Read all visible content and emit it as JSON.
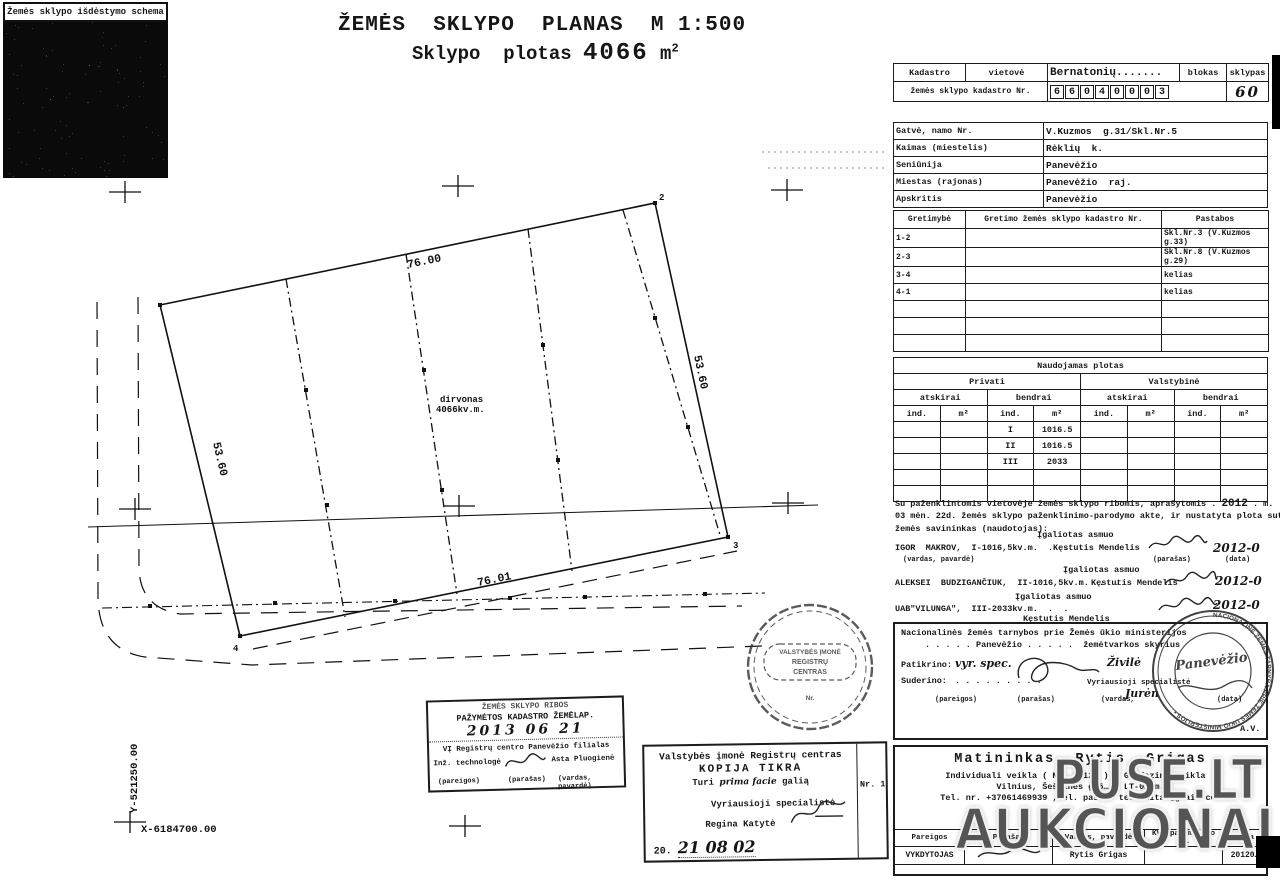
{
  "watermark": {
    "top": "PUSE.LT",
    "bottom": "AUKCIONAI"
  },
  "schema": {
    "caption": "Žemės sklypo išdėstymo schema"
  },
  "title": {
    "line1": "ŽEMĖS  SKLYPO  PLANAS  M 1:500",
    "line2_label": "Sklypo  plotas ",
    "area": "4066",
    "unit": " m",
    "sup": "2"
  },
  "kadastro": {
    "h_kadastro": "Kadastro",
    "h_vietove": "vietovė",
    "vietove_value": "Bernatonių.......",
    "h_blokas": "blokas",
    "h_sklypas": "sklypas",
    "row2_label": "žemės sklypo kadastro Nr.",
    "digits": [
      "6",
      "6",
      "0",
      "4",
      "0",
      "0",
      "0",
      "3"
    ],
    "sklypas_value": "60"
  },
  "address": {
    "rows": [
      {
        "label": "Gatvė, namo Nr.",
        "value": "V.Kuzmos  g.31/Skl.Nr.5"
      },
      {
        "label": "Kaimas (miestelis)",
        "value": "Rėklių  k."
      },
      {
        "label": "Seniūnija",
        "value": "Panevėžio"
      },
      {
        "label": "Miestas (rajonas)",
        "value": "Panevėžio  raj."
      },
      {
        "label": "Apskritis",
        "value": "Panevėžio"
      }
    ]
  },
  "gretimybe": {
    "h1": "Gretimybė",
    "h2": "Gretimo žemės sklypo kadastro Nr.",
    "h3": "Pastabos",
    "rows": [
      {
        "c1": "1-2",
        "c2": "",
        "c3": "Skl.Nr.3 (V.Kuzmos g.33)"
      },
      {
        "c1": "2-3",
        "c2": "",
        "c3": "Skl.Nr.8 (V.Kuzmos g.29)"
      },
      {
        "c1": "3-4",
        "c2": "",
        "c3": "kelias"
      },
      {
        "c1": "4-1",
        "c2": "",
        "c3": "kelias"
      },
      {
        "c1": "",
        "c2": "",
        "c3": ""
      },
      {
        "c1": "",
        "c2": "",
        "c3": ""
      },
      {
        "c1": "",
        "c2": "",
        "c3": ""
      }
    ]
  },
  "plotas": {
    "title": "Naudojamas plotas",
    "privati": "Privati",
    "valstybine": "Valstybinė",
    "atskirai": "atskirai",
    "bendrai": "bendrai",
    "ind": "ind.",
    "m2": "m²",
    "rows": [
      {
        "ind": "I",
        "val": "1016.5"
      },
      {
        "ind": "II",
        "val": "1016.5"
      },
      {
        "ind": "III",
        "val": "2033"
      },
      {
        "ind": "",
        "val": ""
      },
      {
        "ind": "",
        "val": ""
      }
    ]
  },
  "agreement": {
    "line1a": "Su paženklintomis vietovėje žemės sklypo ribomis, aprašytomis . ",
    "year": "2012",
    "line1b": " . m.",
    "line2": "03 mėn. 22d. žemės sklypo paženklinimo-parodymo akte, ir nustatyta plota sutinka",
    "line3": "žemės savininkas (naudotojas):",
    "igaliotas": "Įgaliotas asmuo",
    "owners": [
      {
        "name": "IGOR  MAKROV,  I-1016,5kv.m.  .  .  .",
        "proxy": "Kęstutis Mendelis",
        "date": "2012-0"
      },
      {
        "name": "ALEKSEI  BUDZIGANČIUK,  II-1016,5kv.m.  .  .",
        "proxy": "Kęstutis Mendelis",
        "date": "2012-0"
      },
      {
        "name": "UAB\"VILUNGA\",  III-2033kv.m.  .  .",
        "proxy": "Kęstutis Mendelis",
        "date": "2012-0"
      }
    ],
    "sub_name": "(vardas, pavardė)",
    "sub_sig": "(parašas)",
    "sub_date": "(data)"
  },
  "nzt": {
    "line1": "Nacionalinės žemės tarnybos prie Žemės ūkio ministerijos",
    "dots1": ". . . . .",
    "city": "Panevėžio",
    "dots2": ". . . . .",
    "skyrius": "žemėtvarkos skyrius",
    "patikrino": "Patikrino:",
    "patikrino_hand": "vyr. spec.",
    "patikrino_name_hand": "Živilė",
    "suderino": "Suderino:",
    "dots3": ". . . . . . . . .",
    "role": "Vyriausioji specialistė",
    "name_hand": "Jurėn",
    "sub_pareigos": "(pareigos)",
    "sub_parasas": "(parašas)",
    "sub_vardas": "(vardas,",
    "sub_data": "(data)",
    "av": "A.V.",
    "stamp_rim": "NACIONALINĖ ŽEMĖS TARNYBA PRIE ŽEMĖS ŪKIO MINISTERIJOS • ",
    "stamp_hand": "Panevėžio"
  },
  "seal_rc": {
    "l1": "VALSTYBĖS  ĮMONĖ",
    "l2": "REGISTRŲ",
    "l3": "CENTRAS",
    "l4": "Nr."
  },
  "ribos": {
    "line1": "ŽEMĖS SKLYPO RIBOS",
    "line2": "PAŽYMĖTOS KADASTRO ŽEMĖLAP.",
    "date_hand": "2013 06 21",
    "line3": "VĮ Registrų centro Panevėžio filialas",
    "role": "Inž. technologė",
    "name": "Asta Pluogienė",
    "sub1": "(pareigos)",
    "sub2": "(parašas)",
    "sub3": "(vardas, pavardė)"
  },
  "registru": {
    "line1": "Valstybės įmonė Registrų centras",
    "line2": "KOPIJA TIKRA",
    "line3a": "Turi ",
    "line3b": "prima facie",
    "line3c": " galią",
    "role": "Vyriausioji specialistė",
    "name": "Regina Katytė",
    "date20": "20.",
    "date_hand": "21 08 02",
    "nr": "Nr. 1"
  },
  "matininkas": {
    "title": "Matininkas  Rytis  Grigas",
    "line2": "Individuali veikla ( Nr. 7 124 )  ( Geodezinė veikla )",
    "line3": "Vilnius, Šeškinės g.5… , LT-0… m.",
    "line4": "Tel. nr. +37061469939 , el. paštas teodelitas@gmail.com",
    "h_pareigos": "Pareigos",
    "h_parasas": "Parašas",
    "h_vardas": "Vardas, pavardė",
    "h_kvd": "KVD pažymėjimo Nr.",
    "h_data": "Data",
    "r_pareigos": "VYKDYTOJAS",
    "r_vardas": "Rytis Grigas",
    "r_data": "20120…"
  },
  "plan": {
    "dim_top": "76.00",
    "dim_right": "53.60",
    "dim_left": "53.60",
    "dim_bottom": "76.01",
    "area1": "dirvonas",
    "area2": "4066kv.m.",
    "c2": "2",
    "c3": "3",
    "c4": "4",
    "coord_y": "Y-521250.00",
    "coord_x": "X-6184700.00"
  }
}
